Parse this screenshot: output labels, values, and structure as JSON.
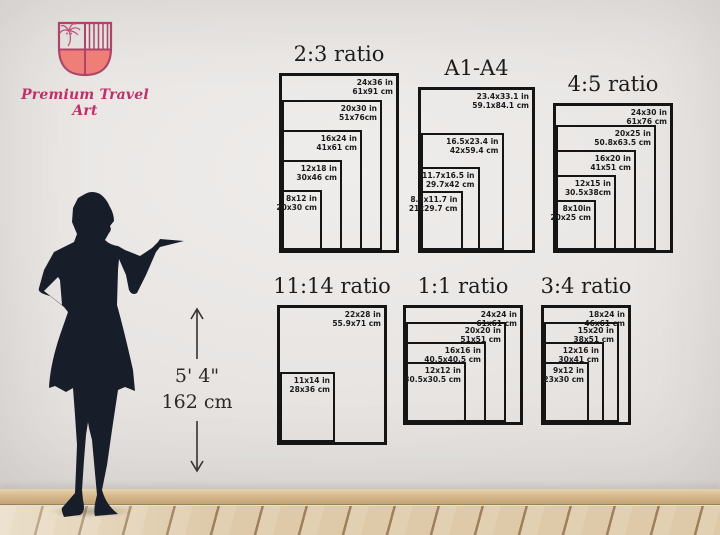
{
  "brand": {
    "name": "Premium Travel Art"
  },
  "height_marker": {
    "imperial": "5' 4\"",
    "metric": "162 cm"
  },
  "colors": {
    "frame": "#151515",
    "wall": "#e8e5e3",
    "floor_wood": "#decaa9",
    "silhouette": "#171d29",
    "brand_pink": "#c02f68",
    "shield_outline": "#ad4568",
    "shield_fill": "#ef7e79"
  },
  "charts_px_per_inch": 5,
  "charts": [
    {
      "id": "2-3",
      "title": "2:3 ratio",
      "left": 279,
      "top": 73,
      "sizes": [
        {
          "w": 24,
          "h": 36,
          "in": "24x36 in",
          "cm": "61x91 cm"
        },
        {
          "w": 20,
          "h": 30,
          "in": "20x30 in",
          "cm": "51x76cm"
        },
        {
          "w": 16,
          "h": 24,
          "in": "16x24 in",
          "cm": "41x61 cm"
        },
        {
          "w": 12,
          "h": 18,
          "in": "12x18 in",
          "cm": "30x46 cm"
        },
        {
          "w": 8,
          "h": 12,
          "in": "8x12 in",
          "cm": "20x30 cm"
        }
      ]
    },
    {
      "id": "a1-a4",
      "title": "A1-A4",
      "left": 418,
      "top": 87,
      "sizes": [
        {
          "w": 23.4,
          "h": 33.1,
          "in": "23.4x33.1 in",
          "cm": "59.1x84.1 cm"
        },
        {
          "w": 16.5,
          "h": 23.4,
          "in": "16.5x23.4 in",
          "cm": "42x59.4 cm"
        },
        {
          "w": 11.7,
          "h": 16.5,
          "in": "11.7x16.5 in",
          "cm": "29.7x42 cm"
        },
        {
          "w": 8.3,
          "h": 11.7,
          "in": "8.3x11.7 in",
          "cm": "21x29.7 cm"
        }
      ]
    },
    {
      "id": "4-5",
      "title": "4:5 ratio",
      "left": 553,
      "top": 103,
      "sizes": [
        {
          "w": 24,
          "h": 30,
          "in": "24x30 in",
          "cm": "61x76 cm"
        },
        {
          "w": 20,
          "h": 25,
          "in": "20x25 in",
          "cm": "50.8x63.5 cm"
        },
        {
          "w": 16,
          "h": 20,
          "in": "16x20 in",
          "cm": "41x51 cm"
        },
        {
          "w": 12,
          "h": 15,
          "in": "12x15 in",
          "cm": "30.5x38cm"
        },
        {
          "w": 8,
          "h": 10,
          "in": "8x10in",
          "cm": "20x25 cm"
        }
      ]
    },
    {
      "id": "11-14",
      "title": "11:14 ratio",
      "left": 277,
      "top": 305,
      "sizes": [
        {
          "w": 22,
          "h": 28,
          "in": "22x28 in",
          "cm": "55.9x71 cm"
        },
        {
          "w": 11,
          "h": 14,
          "in": "11x14 in",
          "cm": "28x36 cm"
        }
      ]
    },
    {
      "id": "1-1",
      "title": "1:1 ratio",
      "left": 403,
      "top": 305,
      "sizes": [
        {
          "w": 24,
          "h": 24,
          "in": "24x24 in",
          "cm": "61x61 cm"
        },
        {
          "w": 20,
          "h": 20,
          "in": "20x20 in",
          "cm": "51x51 cm"
        },
        {
          "w": 16,
          "h": 16,
          "in": "16x16 in",
          "cm": "40.5x40.5 cm"
        },
        {
          "w": 12,
          "h": 12,
          "in": "12x12 in",
          "cm": "30.5x30.5 cm"
        }
      ]
    },
    {
      "id": "3-4",
      "title": "3:4 ratio",
      "left": 541,
      "top": 305,
      "sizes": [
        {
          "w": 18,
          "h": 24,
          "in": "18x24 in",
          "cm": "46x61 cm"
        },
        {
          "w": 15,
          "h": 20,
          "in": "15x20 in",
          "cm": "38x51 cm"
        },
        {
          "w": 12,
          "h": 16,
          "in": "12x16 in",
          "cm": "30x41 cm"
        },
        {
          "w": 9,
          "h": 12,
          "in": "9x12 in",
          "cm": "23x30 cm"
        }
      ]
    }
  ]
}
